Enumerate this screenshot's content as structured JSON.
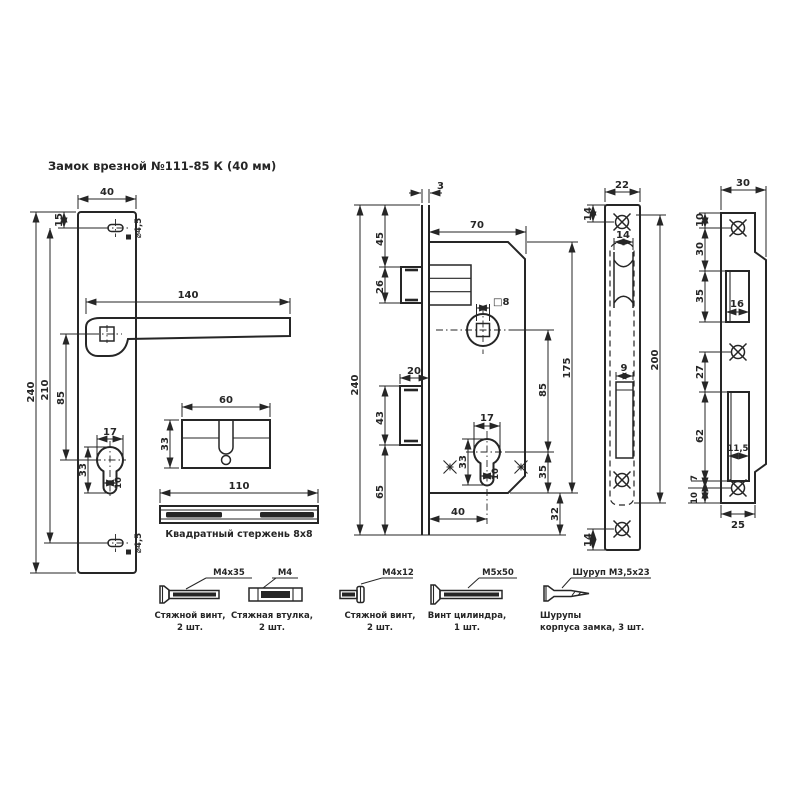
{
  "title": "Замок врезной №111-85 К (40 мм)",
  "colors": {
    "line": "#262626",
    "bg": "#ffffff"
  },
  "views": {
    "handle_plate": {
      "width": "40",
      "top_offset": "15",
      "height": "240",
      "screw_span": "210",
      "handle_to_cyl": "85",
      "handle_length": "140",
      "cyl_width": "17",
      "cyl_height": "33",
      "cyl_slot": "10",
      "hole_top": "⌀4,5",
      "hole_bottom": "⌀4,5"
    },
    "cylinder": {
      "length": "60",
      "height": "33"
    },
    "square_rod": {
      "length": "110",
      "caption": "Квадратный стержень 8х8"
    },
    "lock_body": {
      "faceplate_thickness": "3",
      "top_to_latch": "45",
      "latch_height": "26",
      "body_width": "70",
      "spindle_square": "□8",
      "deadbolt_throw": "20",
      "deadbolt_height": "43",
      "bottom_offset": "65",
      "faceplate_length": "240",
      "cyl_width": "17",
      "cyl_height": "33",
      "cyl_slot": "10",
      "spindle_to_cyl": "85",
      "body_length": "175",
      "cyl_to_bottom": "35",
      "bottom_margin": "32",
      "backset": "40"
    },
    "faceplate": {
      "width": "22",
      "top_screw_offset": "14",
      "latch_width": "14",
      "bolt_slot_width": "9",
      "bottom_screw_offset": "14",
      "length": "200"
    },
    "strike_plate": {
      "top_width": "30",
      "top_screw_offset": "10",
      "screw_to_opening": "30",
      "latch_opening_height": "35",
      "latch_opening_width": "16",
      "opening_gap": "27",
      "bolt_opening_height": "62",
      "bolt_opening_width": "11,5",
      "bolt_to_screw": "7",
      "screw_to_bottom": "10",
      "bottom_width": "25"
    }
  },
  "hardware": [
    {
      "spec": "М4х35",
      "line1": "Стяжной винт,",
      "line2": "2 шт."
    },
    {
      "spec": "М4",
      "line1": "Стяжная втулка,",
      "line2": "2 шт."
    },
    {
      "spec": "М4х12",
      "line1": "Стяжной винт,",
      "line2": "2 шт."
    },
    {
      "spec": "М5х50",
      "line1": "Винт цилиндра,",
      "line2": "1 шт."
    },
    {
      "spec": "Шуруп М3,5х23",
      "line1": "Шурупы",
      "line2": "корпуса замка, 3 шт."
    }
  ]
}
